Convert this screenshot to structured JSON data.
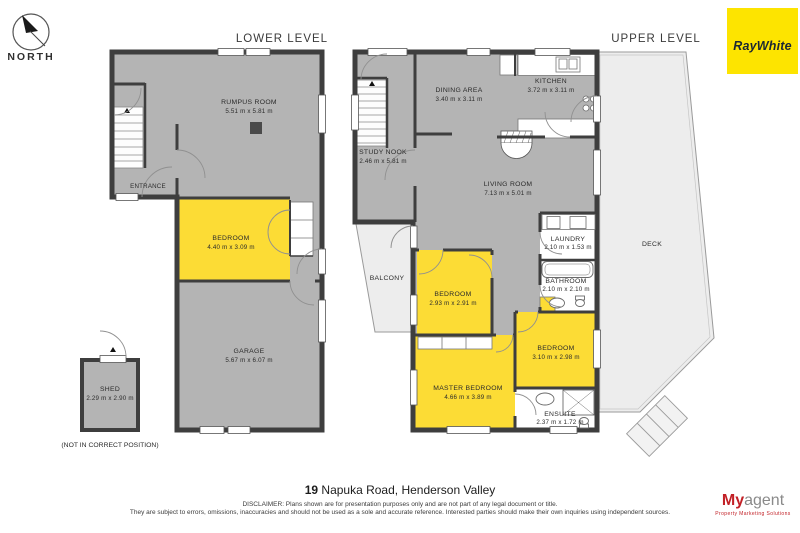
{
  "header": {
    "north_label": "NORTH",
    "lower_level_label": "LOWER LEVEL",
    "upper_level_label": "UPPER LEVEL",
    "brand": "RayWhite"
  },
  "lower_level": {
    "rooms": {
      "rumpus": {
        "name": "RUMPUS ROOM",
        "dims": "5.51 m x 5.81 m"
      },
      "entrance": {
        "name": "ENTRANCE"
      },
      "bedroom": {
        "name": "BEDROOM",
        "dims": "4.40 m x 3.09 m"
      },
      "garage": {
        "name": "GARAGE",
        "dims": "5.67 m x 6.07 m"
      },
      "shed": {
        "name": "SHED",
        "dims": "2.29 m x 2.90 m"
      }
    },
    "note": "(NOT IN CORRECT POSITION)"
  },
  "upper_level": {
    "rooms": {
      "study_nook": {
        "name": "STUDY NOOK",
        "dims": "2.46 m x 5.81 m"
      },
      "dining": {
        "name": "DINING AREA",
        "dims": "3.40 m x 3.11 m"
      },
      "kitchen": {
        "name": "KITCHEN",
        "dims": "3.72 m x 3.11 m"
      },
      "living": {
        "name": "LIVING ROOM",
        "dims": "7.13 m x 5.01 m"
      },
      "laundry": {
        "name": "LAUNDRY",
        "dims": "2.10 m x 1.53 m"
      },
      "bathroom": {
        "name": "BATHROOM",
        "dims": "2.10 m x 2.10 m"
      },
      "deck": {
        "name": "DECK"
      },
      "balcony": {
        "name": "BALCONY"
      },
      "bedroom2": {
        "name": "BEDROOM",
        "dims": "2.93 m x 2.91 m"
      },
      "bedroom3": {
        "name": "BEDROOM",
        "dims": "3.10 m x 2.98 m"
      },
      "master": {
        "name": "MASTER BEDROOM",
        "dims": "4.66 m x 3.89 m"
      },
      "ensuite": {
        "name": "ENSUITE",
        "dims": "2.37 m x 1.72 m"
      }
    }
  },
  "footer": {
    "address_number": "19",
    "address_rest": " Napuka Road, Henderson Valley",
    "disclaimer_line1": "DISCLAIMER: Plans shown are for presentation purposes only and are not part of any legal document or title.",
    "disclaimer_line2": "They are subject to errors, omissions, inaccuracies and should not be used as a sole and accurate reference. Interested parties should make their own inquiries using independent sources.",
    "logo_my": "My",
    "logo_agent": "agent",
    "logo_tagline": "Property Marketing Solutions"
  },
  "colors": {
    "wall": "#3e3e3e",
    "floor_gray": "#b4b4b4",
    "room_yellow": "#fcdc35",
    "outdoor_gray": "#ededed",
    "brand_yellow": "#fde400",
    "logo_red": "#c22026"
  }
}
